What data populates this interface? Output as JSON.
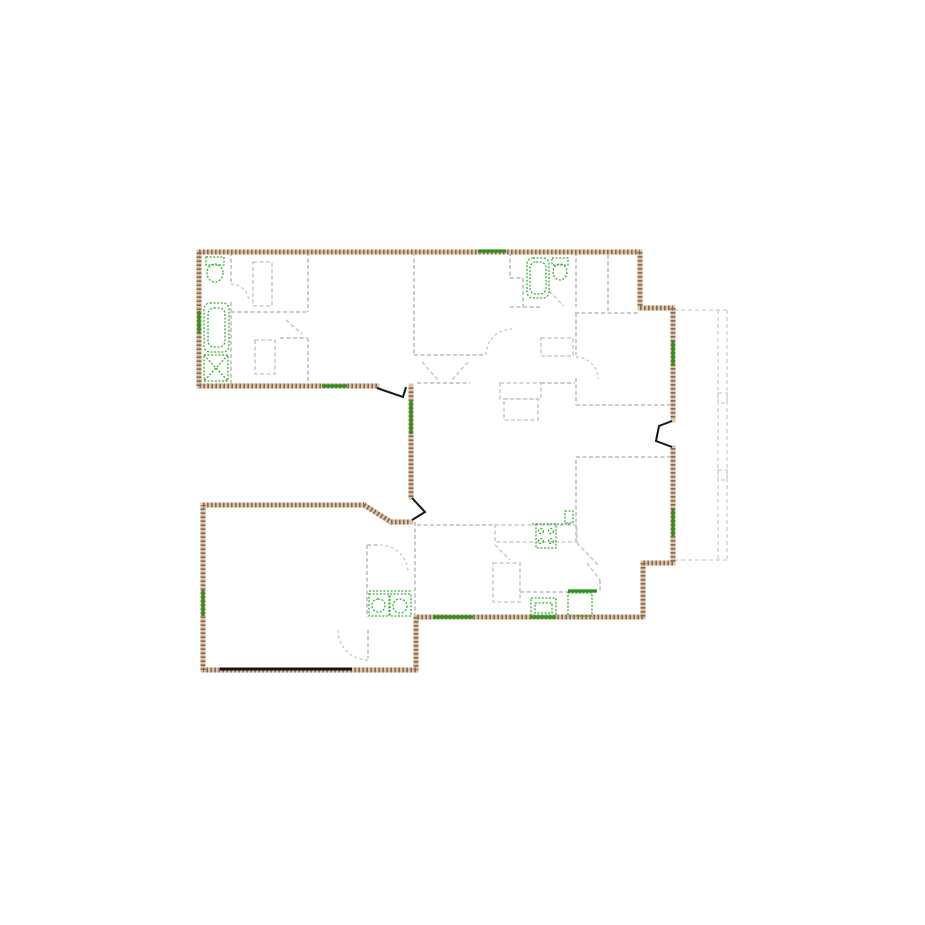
{
  "page": {
    "background": "#ffffff",
    "width": 925,
    "height": 925
  },
  "palette": {
    "wall_base": "#d9c2a6",
    "wall_hatch": "#8a6950",
    "interior_wall": "#cbcbcb",
    "deck": "#d6d6d6",
    "fixture_green": "#35b135",
    "window_green": "#2f8f1f",
    "door_black": "#161616"
  },
  "floor_plan": {
    "exterior_walls": [
      [
        199,
        252,
        640,
        252
      ],
      [
        640,
        252,
        640,
        308
      ],
      [
        640,
        308,
        673,
        308
      ],
      [
        673,
        308,
        673,
        420
      ],
      [
        673,
        448,
        673,
        563
      ],
      [
        673,
        563,
        643,
        563
      ],
      [
        643,
        563,
        643,
        617
      ],
      [
        643,
        617,
        416,
        617
      ],
      [
        416,
        617,
        416,
        670
      ],
      [
        416,
        670,
        203,
        670
      ],
      [
        203,
        670,
        203,
        505
      ],
      [
        203,
        505,
        364,
        505
      ],
      [
        364,
        505,
        391,
        522
      ],
      [
        391,
        522,
        411,
        522
      ],
      [
        411,
        497,
        411,
        386
      ],
      [
        377,
        386,
        199,
        386
      ],
      [
        199,
        386,
        199,
        252
      ]
    ],
    "windows": [
      [
        478,
        251,
        506,
        251
      ],
      [
        322,
        386,
        347,
        386
      ],
      [
        199,
        311,
        199,
        333
      ],
      [
        411,
        401,
        411,
        434
      ],
      [
        673,
        341,
        673,
        366
      ],
      [
        673,
        509,
        673,
        536
      ],
      [
        433,
        617,
        473,
        617
      ],
      [
        530,
        617,
        556,
        617
      ],
      [
        203,
        590,
        203,
        616
      ],
      [
        568,
        591,
        597,
        591
      ]
    ],
    "doors_black": [
      [
        [
          377,
          388
        ],
        [
          403,
          397
        ],
        [
          406,
          387
        ]
      ],
      [
        [
          412,
          498
        ],
        [
          425,
          512
        ],
        [
          412,
          520
        ]
      ],
      [
        [
          672,
          421
        ],
        [
          659,
          426
        ],
        [
          656,
          441
        ],
        [
          672,
          447
        ]
      ]
    ],
    "garage_door": [
      220,
      669,
      352,
      669
    ],
    "interior_walls": [
      [
        231,
        252,
        231,
        284
      ],
      [
        231,
        302,
        231,
        386
      ],
      [
        308,
        252,
        308,
        312
      ],
      [
        231,
        312,
        308,
        312
      ],
      [
        308,
        338,
        308,
        386
      ],
      [
        280,
        338,
        308,
        338
      ],
      [
        414,
        252,
        414,
        355
      ],
      [
        414,
        355,
        484,
        355
      ],
      [
        510,
        252,
        510,
        278
      ],
      [
        510,
        278,
        523,
        278
      ],
      [
        523,
        278,
        523,
        307
      ],
      [
        510,
        307,
        542,
        307
      ],
      [
        576,
        252,
        576,
        307
      ],
      [
        576,
        313,
        576,
        355
      ],
      [
        576,
        378,
        576,
        405
      ],
      [
        575,
        313,
        638,
        313
      ],
      [
        608,
        255,
        608,
        313
      ],
      [
        576,
        405,
        670,
        405
      ],
      [
        576,
        457,
        670,
        457
      ],
      [
        576,
        460,
        576,
        543
      ],
      [
        417,
        383,
        470,
        383
      ],
      [
        541,
        383,
        575,
        383
      ],
      [
        417,
        525,
        495,
        525
      ],
      [
        520,
        592,
        568,
        592
      ],
      [
        415,
        522,
        415,
        617
      ],
      [
        367,
        545,
        367,
        617
      ],
      [
        367,
        545,
        378,
        545
      ],
      [
        600,
        580,
        600,
        592
      ],
      [
        368,
        630,
        368,
        658
      ]
    ],
    "interior_rects": [
      [
        253,
        262,
        19,
        44
      ],
      [
        255,
        340,
        20,
        34
      ],
      [
        500,
        383,
        41,
        16
      ],
      [
        504,
        399,
        34,
        21
      ],
      [
        541,
        338,
        32,
        18
      ],
      [
        495,
        525,
        82,
        17
      ],
      [
        493,
        563,
        27,
        39
      ]
    ],
    "diagonal_marks": [
      [
        286,
        320,
        302,
        334
      ],
      [
        422,
        362,
        438,
        380
      ],
      [
        468,
        362,
        452,
        380
      ],
      [
        549,
        291,
        564,
        306
      ],
      [
        495,
        545,
        510,
        560
      ],
      [
        577,
        543,
        598,
        565
      ],
      [
        587,
        563,
        600,
        580
      ]
    ],
    "door_arcs": [
      "M 231 284 A 18 18 0 0 1 249 302",
      "M 486 355 A 26 26 0 0 1 512 329",
      "M 576 357 A 22 22 0 0 1 598 379",
      "M 380 545 A 28 28 0 0 1 408 573",
      "M 368 660 A 30 30 0 0 1 338 630"
    ],
    "deck": {
      "lines": [
        [
          674,
          310,
          727,
          310
        ],
        [
          727,
          310,
          727,
          560
        ],
        [
          727,
          560,
          674,
          560
        ],
        [
          718,
          310,
          718,
          560
        ]
      ],
      "posts": [
        [
          718,
          393,
          9,
          10
        ],
        [
          718,
          470,
          9,
          10
        ]
      ]
    },
    "fixtures": {
      "rects": [
        {
          "name": "toilet-tank",
          "r": [
            206,
            257,
            18,
            8
          ]
        },
        {
          "name": "shower-stall",
          "r": [
            204,
            355,
            24,
            26
          ]
        },
        {
          "name": "toilet-tank",
          "r": [
            552,
            258,
            16,
            7
          ]
        },
        {
          "name": "cooktop",
          "r": [
            536,
            524,
            20,
            24
          ]
        },
        {
          "name": "cooktop-side",
          "r": [
            565,
            511,
            8,
            12
          ]
        },
        {
          "name": "kitchen-sink",
          "r": [
            531,
            598,
            25,
            18
          ]
        },
        {
          "name": "sink-bowl",
          "r": [
            535,
            603,
            17,
            10
          ]
        },
        {
          "name": "dishwasher",
          "r": [
            568,
            593,
            24,
            23
          ]
        },
        {
          "name": "washer",
          "r": [
            369,
            594,
            20,
            22
          ]
        },
        {
          "name": "dryer",
          "r": [
            390,
            594,
            21,
            22
          ]
        }
      ],
      "round_rects": [
        {
          "name": "bathtub-outer",
          "r": [
            204,
            303,
            25,
            49
          ]
        },
        {
          "name": "bathtub-inner",
          "r": [
            208,
            308,
            17,
            39
          ]
        },
        {
          "name": "bathtub-outer",
          "r": [
            527,
            258,
            22,
            40
          ]
        },
        {
          "name": "bathtub-inner",
          "r": [
            530,
            262,
            16,
            32
          ]
        },
        {
          "name": "washer-drum",
          "r": [
            372,
            599,
            13,
            13
          ]
        }
      ],
      "ellipses": [
        {
          "name": "toilet-bowl",
          "e": [
            215,
            273,
            8,
            9
          ]
        },
        {
          "name": "toilet-bowl",
          "e": [
            560,
            272,
            7,
            8
          ]
        },
        {
          "name": "dryer-drum",
          "e": [
            400,
            606,
            7,
            7
          ]
        },
        {
          "name": "burner",
          "e": [
            541,
            531,
            2.5,
            2.5
          ]
        },
        {
          "name": "burner",
          "e": [
            551,
            531,
            2.5,
            2.5
          ]
        },
        {
          "name": "burner",
          "e": [
            541,
            541,
            2.5,
            2.5
          ]
        },
        {
          "name": "burner",
          "e": [
            551,
            541,
            2.5,
            2.5
          ]
        }
      ],
      "lines": [
        [
          204,
          355,
          228,
          381
        ],
        [
          228,
          355,
          204,
          381
        ],
        [
          532,
          524,
          570,
          524
        ],
        [
          369,
          591,
          411,
          591
        ]
      ]
    }
  }
}
